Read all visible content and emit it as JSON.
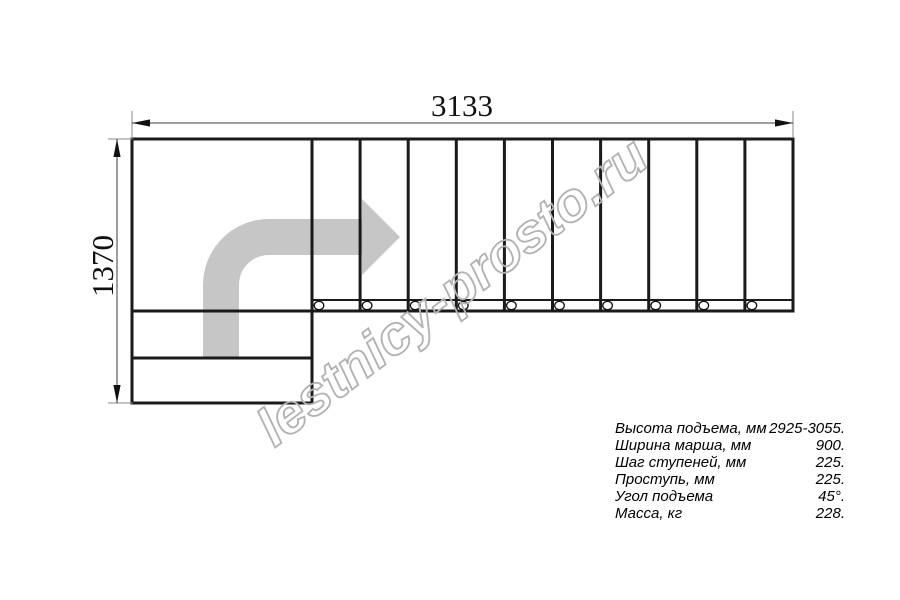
{
  "watermark": {
    "text": "lestnicy-prosto.ru"
  },
  "dimensions": {
    "overall_length_mm": "3133",
    "overall_depth_mm": "1370"
  },
  "stair": {
    "straight_treads": 10,
    "fastener_circles": 10,
    "lower_winder_steps": 2
  },
  "specs": {
    "rows": [
      {
        "label": "Высота подъема, мм",
        "value": "2925-3055."
      },
      {
        "label": "Ширина марша, мм",
        "value": "900."
      },
      {
        "label": "Шаг ступеней, мм",
        "value": "225."
      },
      {
        "label": "Проступь, мм",
        "value": "225."
      },
      {
        "label": "Угол подъема",
        "value": "45°."
      },
      {
        "label": "Масса, кг",
        "value": "228."
      }
    ]
  },
  "colors": {
    "line": "#1a1a1a",
    "arrow": "#c6c6c6",
    "watermark": "#b2b2b2"
  }
}
